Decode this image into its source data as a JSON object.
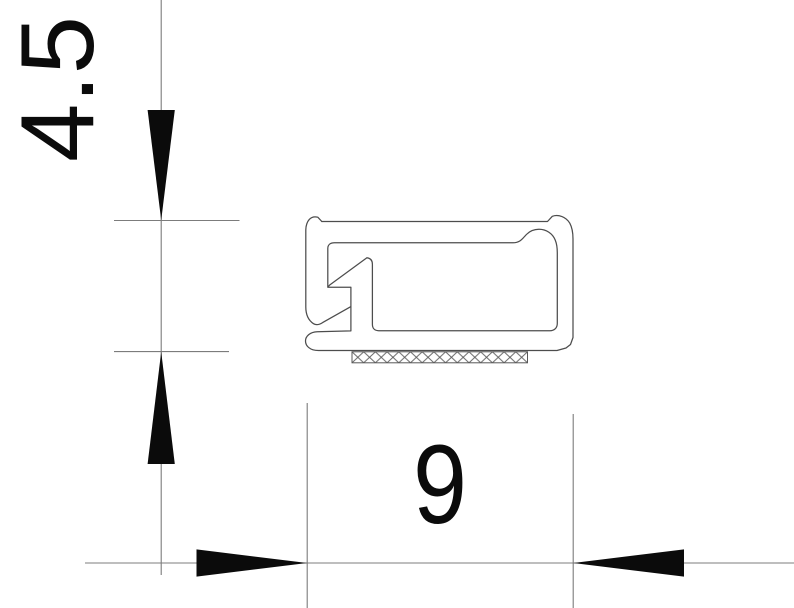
{
  "figure": {
    "dimensions": {
      "height": {
        "label": "4.5"
      },
      "width": {
        "label": "9"
      }
    },
    "colors": {
      "background": "#ffffff",
      "profile_outline": "#4d4d4d",
      "dimension_lines": "#7c7c7c",
      "arrows_and_text": "#0b0b0b"
    }
  }
}
